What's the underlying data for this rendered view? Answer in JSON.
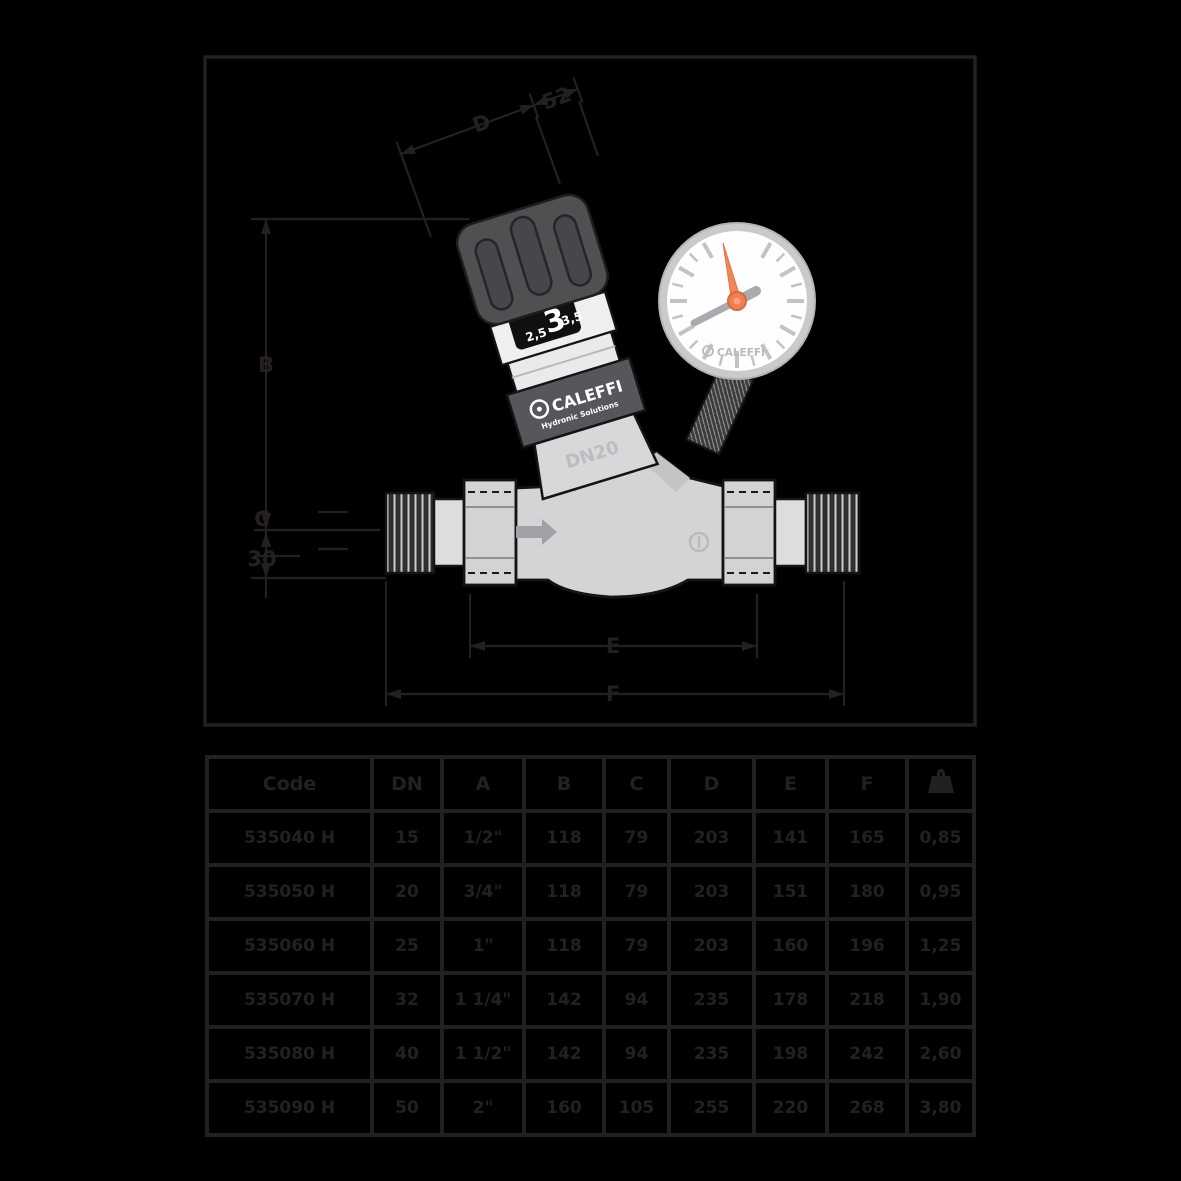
{
  "drawing": {
    "dim_labels": {
      "incline_long": "D",
      "incline_short": "52",
      "height": "B",
      "below_axis_1": "C",
      "below_axis_2": "30",
      "inner_length": "E",
      "overall_length": "F"
    },
    "valve": {
      "knob_scale_left": "2,5",
      "knob_scale_center": "3",
      "knob_scale_right": "3,5",
      "brand": "CALEFFI",
      "brand_sub": "Hydronic Solutions",
      "body_size_label": "DN20",
      "gauge_brand": "CALEFFI"
    },
    "colors": {
      "line": "#242021",
      "body_gray": "#d2d4d6",
      "band_gray": "#55575a",
      "knob_dark": "#4e5052",
      "needle_orange": "#f2865a"
    }
  },
  "table": {
    "headers": [
      "Code",
      "DN",
      "A",
      "B",
      "C",
      "D",
      "E",
      "F"
    ],
    "weight_header_icon": "weight-icon",
    "rows": [
      [
        "535040 H",
        "15",
        "1/2\"",
        "118",
        "79",
        "203",
        "141",
        "165",
        "0,85"
      ],
      [
        "535050 H",
        "20",
        "3/4\"",
        "118",
        "79",
        "203",
        "151",
        "180",
        "0,95"
      ],
      [
        "535060 H",
        "25",
        "1\"",
        "118",
        "79",
        "203",
        "160",
        "196",
        "1,25"
      ],
      [
        "535070 H",
        "32",
        "1 1/4\"",
        "142",
        "94",
        "235",
        "178",
        "218",
        "1,90"
      ],
      [
        "535080 H",
        "40",
        "1 1/2\"",
        "142",
        "94",
        "235",
        "198",
        "242",
        "2,60"
      ],
      [
        "535090 H",
        "50",
        "2\"",
        "160",
        "105",
        "255",
        "220",
        "268",
        "3,80"
      ]
    ]
  }
}
